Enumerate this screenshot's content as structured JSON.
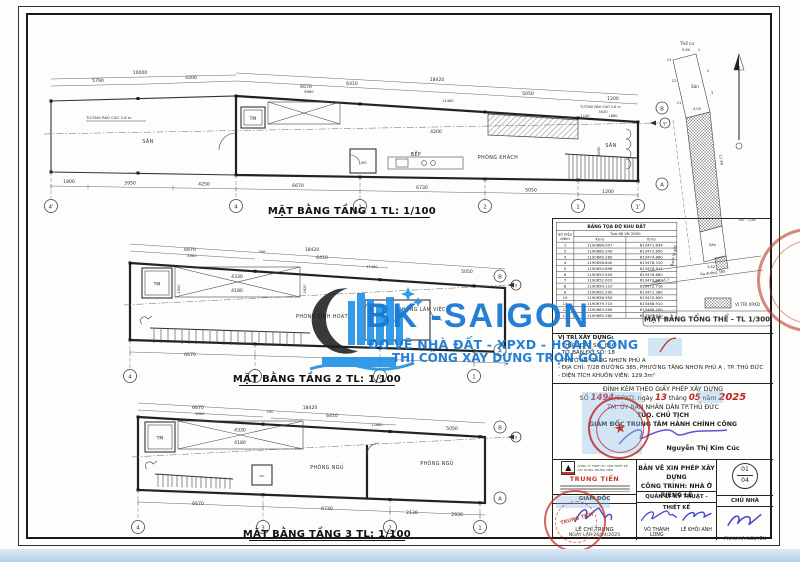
{
  "watermark": {
    "title": "BK -SAIGON",
    "sub1": "ĐO VẼ NHÀ ĐẤT - XPXD - HOÀN CÔNG",
    "sub2": "THI CÔNG XÂY DỰNG TRỌN GÓI",
    "blue": "#1879d3"
  },
  "floor1": {
    "title": "MẶT BẰNG TẦNG 1 TL: 1/100",
    "fence_left": "TƯỜNG RÀO CAO 2.6 m",
    "fence_right": "TƯỜNG RÀO CAO 2.6 m",
    "rooms": {
      "san_left": "SÂN",
      "bep": "BẾP",
      "khach": "PHÒNG KHÁCH",
      "san_right": "SÂN",
      "tm": "TM",
      "wc": "WC"
    },
    "top_dims": [
      "10000",
      "5790",
      "4200",
      "18420",
      "6410",
      "5050",
      "1200",
      "6670",
      "6960",
      "11480",
      "3020",
      "1140",
      "1880"
    ],
    "bottom_dims": [
      "1800",
      "3950",
      "4250",
      "6670",
      "6730",
      "5050",
      "1200"
    ],
    "inner_dims": [
      "4200",
      "8250"
    ],
    "grid_bottom": [
      "4'",
      "4",
      "3",
      "2",
      "1",
      "1'"
    ],
    "grid_right": [
      "B",
      "Y'",
      "A"
    ]
  },
  "floor2": {
    "title": "MẶT BẰNG TẦNG 2 TL: 1/100",
    "rooms": {
      "work": "PHÒNG LÀM VIỆC",
      "living": "PHÒNG SINH HOẠT",
      "tm": "TM",
      "wc": "WC"
    },
    "top_dims": [
      "18420",
      "6670",
      "6960",
      "290",
      "6410",
      "11480",
      "5050"
    ],
    "bottom_dims": [
      "6670"
    ],
    "inner_dims": [
      "4330",
      "4180",
      "1500",
      "1820"
    ],
    "grid_bottom": [
      "4",
      "3",
      "2",
      "1"
    ],
    "grid_right": [
      "B",
      "Y",
      "A"
    ]
  },
  "floor3": {
    "title": "MẶT BẰNG TẦNG 3 TL: 1/100",
    "rooms": {
      "bed1": "PHÒNG NGỦ",
      "bed2": "PHÒNG NGỦ",
      "tm": "TM",
      "wc": "WC"
    },
    "top_dims": [
      "18420",
      "6670",
      "6960",
      "290",
      "6410",
      "12680",
      "5050"
    ],
    "bottom_dims": [
      "6670",
      "6730",
      "2130",
      "2930"
    ],
    "inner_dims": [
      "4330",
      "4180"
    ],
    "grid_bottom": [
      "4",
      "3",
      "2",
      "1"
    ],
    "grid_right": [
      "B",
      "Y",
      "A"
    ]
  },
  "siteplan": {
    "title": "MẶT BẰNG TỔNG THỂ - TL 1/300",
    "legend": "VỊ TRÍ XPXD",
    "tho_cu": "Thổ cư",
    "san_top": "Sân",
    "san_bottom": "Sân",
    "ns": "NS : 7/28",
    "hem": "hẻm số 7",
    "duong": "Ra đường 385",
    "ranh": "Ranh lộ giới",
    "dims": [
      "5.80",
      "4.05",
      "3.82",
      "11.49"
    ],
    "vertices": [
      "13",
      "1",
      "12",
      "2",
      "11",
      "3"
    ]
  },
  "coord_table": {
    "title": "BẢNG TỌA ĐỘ KHU ĐẤT",
    "subtitle": "Tọa độ VN 2000",
    "col_point": "Số hiệu điểm",
    "col_x": "X(m)",
    "col_y": "Y(m)",
    "rows": [
      [
        "1",
        "1190686.007",
        "613471.644"
      ],
      [
        "2",
        "1190680.340",
        "613472.850"
      ],
      [
        "3",
        "1190669.280",
        "613474.880"
      ],
      [
        "4",
        "1190656.840",
        "613476.310"
      ],
      [
        "5",
        "1190654.896",
        "613476.517"
      ],
      [
        "6",
        "1190653.500",
        "613476.680"
      ],
      [
        "7",
        "1190652.610",
        "613472.962"
      ],
      [
        "8",
        "1190654.110",
        "613472.716"
      ],
      [
        "9",
        "1190652.290",
        "613471.380"
      ],
      [
        "10",
        "1190656.950",
        "613470.800"
      ],
      [
        "11",
        "1190679.710",
        "613468.910"
      ],
      [
        "12",
        "1190683.590",
        "613468.200"
      ],
      [
        "13",
        "1190685.360",
        "613467.650"
      ]
    ]
  },
  "location": {
    "heading": "VỊ TRÍ XÂY DỰNG:",
    "lines": [
      "- THỬA ĐẤT SỐ:  856",
      "- TỜ BẢN ĐỒ SỐ:  18",
      "- PHƯỜNG:  TĂNG NHƠN PHÚ A",
      "- ĐỊA CHỈ:  7/28 ĐƯỜNG 385, PHƯỜNG TĂNG NHƠN PHÚ A , TP. THỦ ĐỨC",
      "- DIỆN TÍCH KHUÔN VIÊN:  129.3m²"
    ]
  },
  "permit": {
    "line1": "ĐÍNH KÈM THEO GIẤY PHÉP XÂY DỰNG",
    "so": "SỐ ",
    "no": "1494",
    "gpxd": "/GPXD, ngày ",
    "day": "13",
    "thang": " tháng ",
    "month": "05",
    "nam": " năm ",
    "year": "2025",
    "line3": "TM. ỦY BAN NHÂN DÂN TP.THỦ ĐỨC",
    "line4": "TUQ. CHỦ TỊCH",
    "line5": "GIÁM ĐỐC TRUNG TÂM HÀNH CHÍNH CÔNG",
    "signer": "Nguyễn Thị Kim Cúc"
  },
  "titleblock": {
    "company_line1": "CÔNG TY TNHH TƯ VẤN THIẾT KẾ",
    "company_line2": "XÂY DỰNG TRUNG TIẾN",
    "company_name": "TRUNG TIẾN",
    "giam_doc": "GIÁM ĐỐC",
    "drawn_name": "LÊ CHÍ TRUNG",
    "date_line": "NGÀY LẬP 26/04/2025",
    "doc_line1": "BẢN VẼ XIN PHÉP XÂY DỰNG",
    "doc_line2": "CÔNG TRÌNH: NHÀ Ở RIÊNG LẺ",
    "role_tech": "QUẢN LÝ KỸ THUẬT - THIẾT KẾ",
    "role_owner": "CHỦ NHÀ",
    "name_tech1": "VÕ THÀNH LONG",
    "name_tech2": "LÊ KHÔI ANH",
    "name_owner": "PHAN HÀ NGUYÊN",
    "sheet_no": "01",
    "sheet_total": "04",
    "stamp_text": "TRUNG TIẾN",
    "seal_star": "★"
  }
}
